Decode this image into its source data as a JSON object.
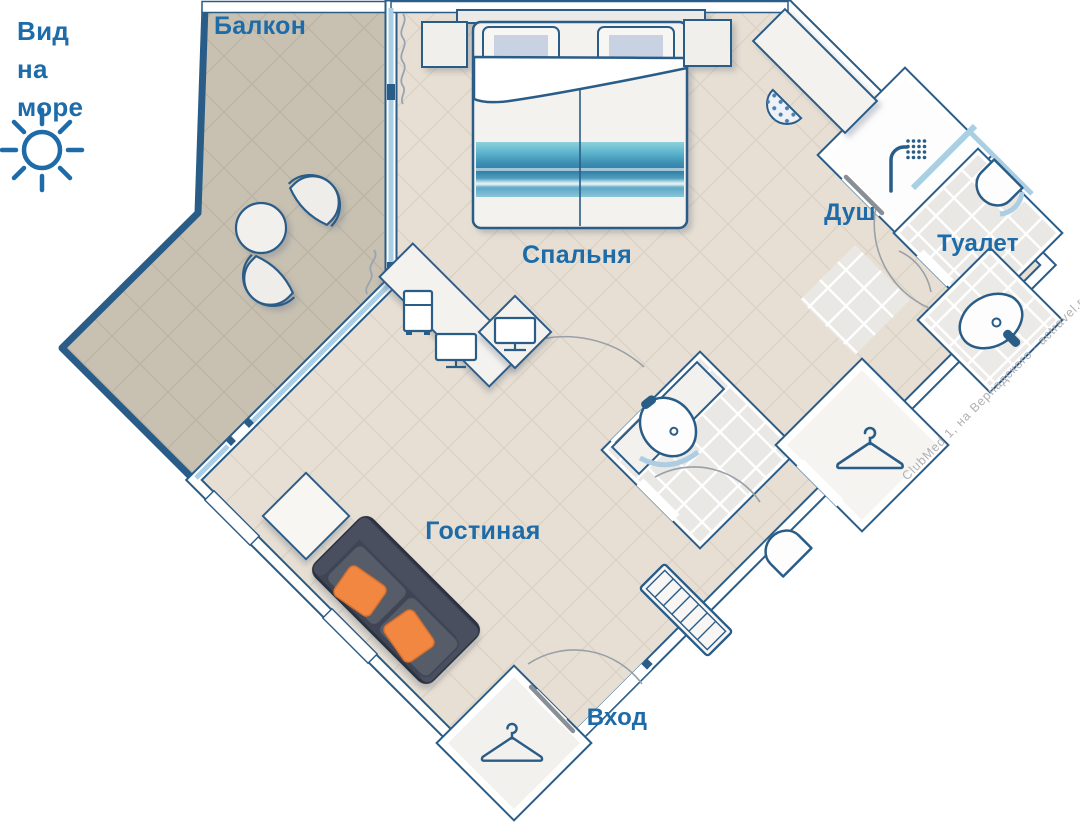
{
  "sea_view": {
    "line1": "Вид",
    "line2": "на",
    "line3": "море"
  },
  "rooms": {
    "balcony": "Балкон",
    "bedroom": "Спальня",
    "shower": "Душ",
    "toilet": "Туалет",
    "living_room": "Гостиная",
    "entrance": "Вход"
  },
  "watermark": "ClubMed 1, на Вернадского · actravel.ru",
  "icons": {
    "sun": "sun-icon",
    "shower_head": "shower-head-icon",
    "hanger": "hanger-icon",
    "sink": "sink-icon",
    "toilet": "toilet-icon",
    "mini_fridge": "mini-fridge-icon",
    "tv": "tv-icon",
    "double_bed": "double-bed",
    "sofa": "sofa",
    "balcony_chair": "balcony-chair",
    "round_table": "round-table"
  },
  "colors": {
    "wall_outline": "#2a5c88",
    "label_text": "#1d6ba8",
    "glass": "#a9cfe4",
    "floor_main": "#e7dfd3",
    "floor_balcony": "#c8c1b2",
    "floor_bath": "#e9e8e4",
    "sofa": "#3f4454",
    "sofa_pillow": "#f28742",
    "sea_photo": "#4a9fc0",
    "watermark_text": "#b0b0b3"
  }
}
